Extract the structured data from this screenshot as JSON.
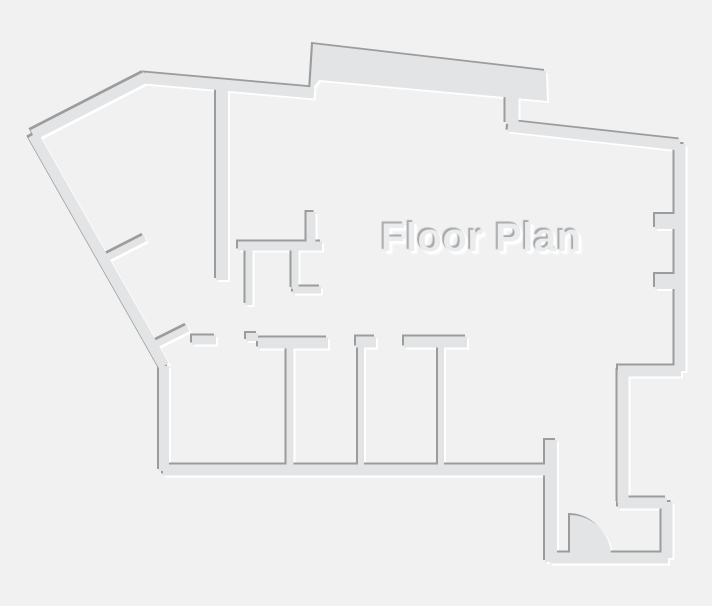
{
  "title": "Floor Plan",
  "colors": {
    "background": "#f1f1f2",
    "wall": "#e2e4e5",
    "shadow_dark": "#9c9c9c",
    "shadow_light": "#ffffff",
    "title_fill": "#ebeced",
    "title_shadow_dark": "#a9aaab",
    "title_shadow_light": "#ffffff"
  },
  "floor_plan": {
    "canvas": {
      "width": 712,
      "height": 606
    },
    "emboss": {
      "dark_dx": -2,
      "dark_dy": -2,
      "light_dx": 2.5,
      "light_dy": 2.5
    },
    "wall_segments": [
      [
        33,
        135,
        146,
        77,
        11
      ],
      [
        144,
        78,
        314,
        93,
        11
      ],
      [
        512,
        97,
        512,
        124,
        13
      ],
      [
        508,
        126,
        680,
        145,
        11
      ],
      [
        680,
        144,
        680,
        371,
        11
      ],
      [
        681,
        371,
        618,
        371,
        11
      ],
      [
        623,
        370,
        623,
        503,
        11
      ],
      [
        618,
        503,
        667,
        503,
        11
      ],
      [
        667,
        502,
        667,
        558,
        11
      ],
      [
        668,
        558,
        550,
        558,
        11
      ],
      [
        551,
        562,
        551,
        440,
        12
      ],
      [
        556,
        470,
        163,
        470,
        11
      ],
      [
        164,
        471,
        164,
        366,
        10
      ],
      [
        164,
        366,
        33,
        135,
        11
      ],
      [
        104,
        259,
        145,
        238,
        7
      ],
      [
        154,
        345,
        188,
        328,
        7
      ],
      [
        222,
        88,
        222,
        280,
        12
      ],
      [
        238,
        246,
        322,
        246,
        9
      ],
      [
        311,
        212,
        311,
        244,
        9
      ],
      [
        249,
        247,
        249,
        305,
        7
      ],
      [
        295,
        247,
        295,
        289,
        7
      ],
      [
        293,
        290,
        321,
        290,
        7
      ],
      [
        192,
        340,
        216,
        340,
        9
      ],
      [
        246,
        337,
        258,
        337,
        8
      ],
      [
        258,
        343,
        328,
        343,
        11
      ],
      [
        290,
        346,
        290,
        465,
        7
      ],
      [
        356,
        342,
        376,
        342,
        11
      ],
      [
        361,
        346,
        361,
        465,
        6
      ],
      [
        404,
        342,
        467,
        342,
        11
      ],
      [
        441,
        347,
        441,
        465,
        6
      ]
    ],
    "wall_polygons": [
      {
        "name": "top-bump-wall",
        "points": [
          [
            310,
            92
          ],
          [
            313,
            44
          ],
          [
            546,
            71
          ],
          [
            547,
            101
          ],
          [
            319,
            80
          ]
        ]
      },
      {
        "name": "right-wall-niche-upper",
        "points": [
          [
            655,
            214
          ],
          [
            677,
            214
          ],
          [
            677,
            229
          ],
          [
            655,
            229
          ]
        ]
      },
      {
        "name": "right-wall-niche-lower",
        "points": [
          [
            655,
            274
          ],
          [
            677,
            274
          ],
          [
            677,
            289
          ],
          [
            655,
            289
          ]
        ]
      }
    ],
    "door": {
      "cx": 570,
      "cy": 556,
      "r": 41
    }
  }
}
